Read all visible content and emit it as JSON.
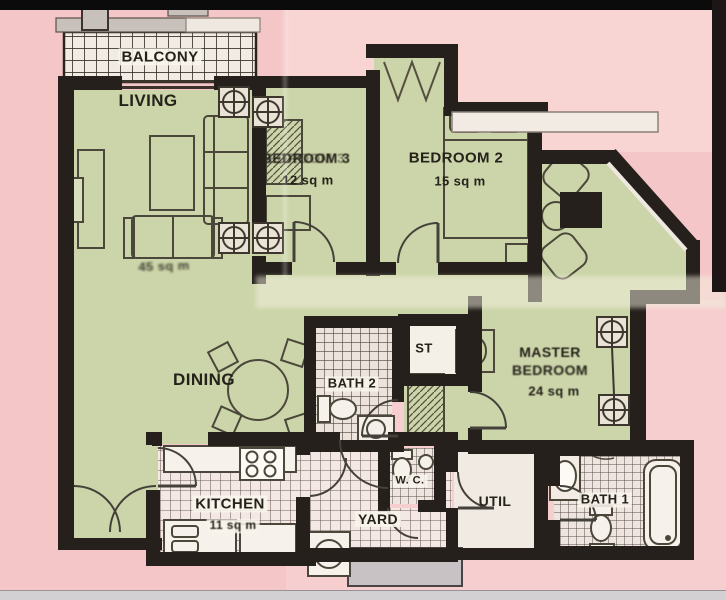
{
  "plan_type": "apartment-floor-plan",
  "rooms": {
    "balcony": {
      "label": "BALCONY"
    },
    "living": {
      "label": "LIVING",
      "area_smudged": "45 sq m"
    },
    "dining": {
      "label": "DINING"
    },
    "bedroom3": {
      "label": "BEDROOM 3",
      "area": "12 sq m"
    },
    "bedroom2": {
      "label": "BEDROOM 2",
      "area": "15 sq m"
    },
    "master_bedroom": {
      "label_line1": "MASTER",
      "label_line2": "BEDROOM",
      "area": "24 sq m"
    },
    "bath2": {
      "label": "BATH 2"
    },
    "store": {
      "label": "ST"
    },
    "kitchen": {
      "label": "KITCHEN",
      "area": "11 sq m"
    },
    "yard": {
      "label": "YARD"
    },
    "wc": {
      "label": "W. C."
    },
    "util": {
      "label": "UTIL"
    },
    "bath1": {
      "label": "BATH 1"
    }
  },
  "colors": {
    "background_pink": "#f4c6c8",
    "background_pink_light": "#f8d5d3",
    "floor_green": "#ccd5a9",
    "wall_dark": "#26201c",
    "tile_light": "#f3ebe6",
    "label_ink": "#25221b",
    "ledge_gray": "#c7c0bb"
  }
}
